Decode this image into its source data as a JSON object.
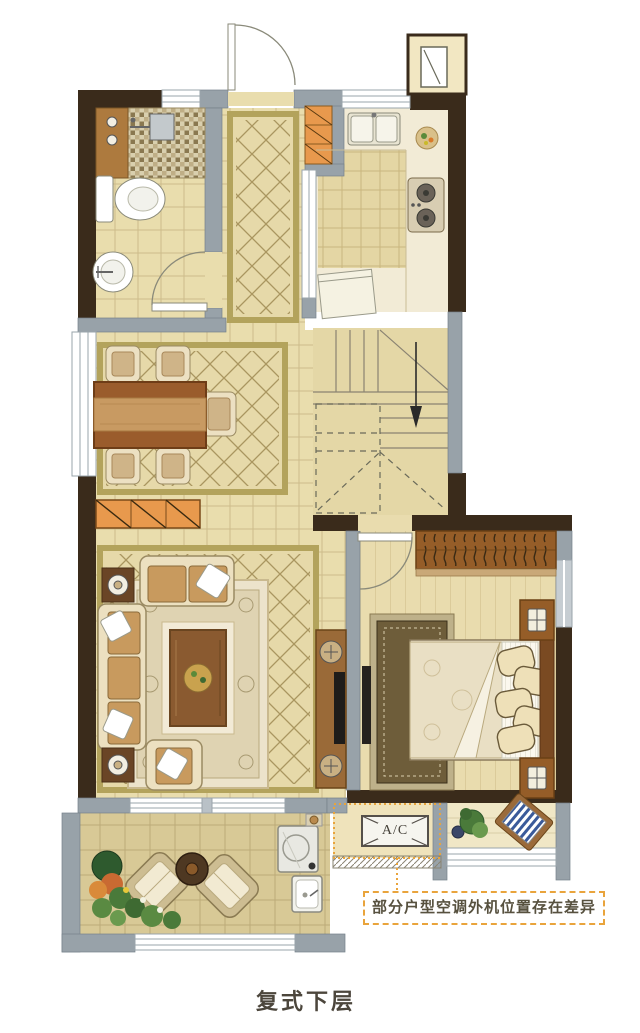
{
  "annotations": {
    "ac_label": "A/C",
    "ac_note": "部分户型空调外机位置存在差异"
  },
  "caption": "复式下层",
  "palette": {
    "wall_dark": "#3a2b1b",
    "wall_gray": "#98a2a9",
    "window_white": "#ffffff",
    "floor_tile": "#e9ddad",
    "floor_grid_line": "#cdbc8a",
    "floor_kitchen": "#e4d6a4",
    "floor_wood": "#e9dcae",
    "floor_balcony": "#d8c996",
    "rug_border_khaki": "#b3a35c",
    "cabinet_orange": "#e8994d",
    "wood_brown": "#9a5c2c",
    "sofa_cream": "#ece0c0",
    "cushion_tan": "#c89a5e",
    "accent_dashed_orange": "#e9a43c",
    "note_text": "#57513f",
    "plant_green": "#4a7a3a"
  }
}
